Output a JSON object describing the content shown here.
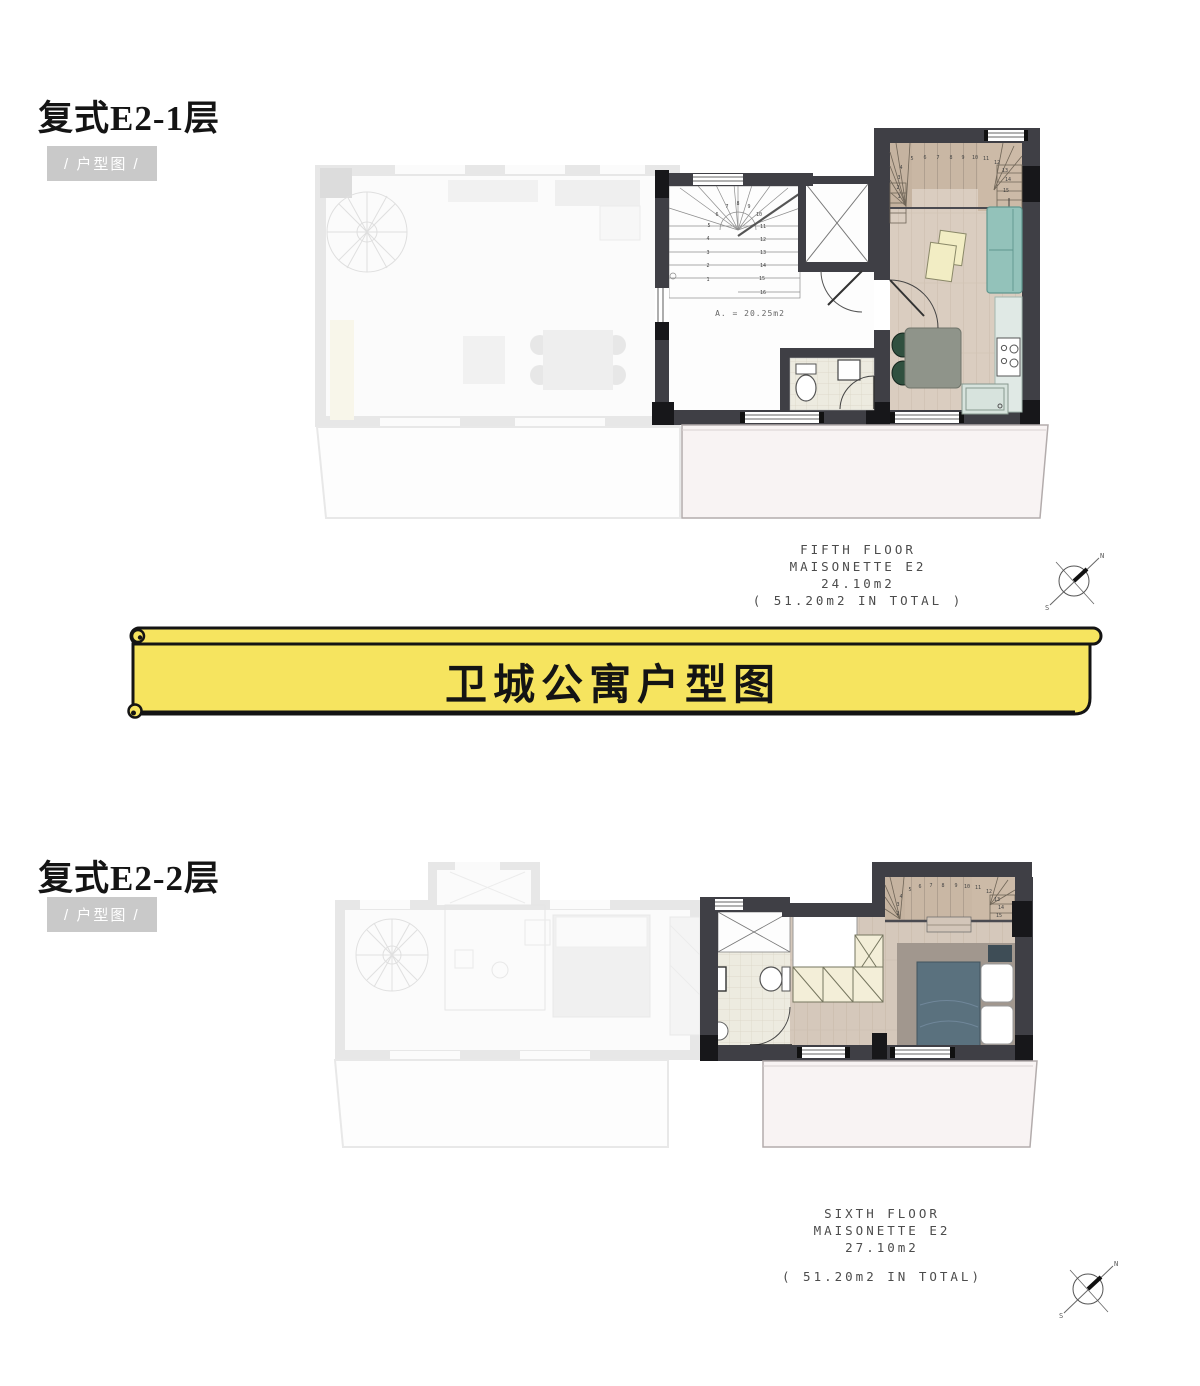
{
  "banner": {
    "title": "卫城公寓户型图",
    "fill": "#f6e45f"
  },
  "compass": {
    "north": "N",
    "south": "S"
  },
  "section1": {
    "heading": "复式E2-1层",
    "badge": "/ 户型图 /",
    "plan": {
      "area_label": "A. = 20.25m2",
      "stairwell_step_numbers": [
        "1",
        "2",
        "3",
        "4",
        "5",
        "6",
        "7",
        "8",
        "9",
        "10",
        "11",
        "12",
        "13",
        "14",
        "15",
        "16"
      ],
      "unit_stair_numbers": [
        "1",
        "2",
        "3",
        "4",
        "5",
        "6",
        "7",
        "8",
        "9",
        "10",
        "11",
        "12",
        "13",
        "14",
        "15"
      ]
    },
    "caption": {
      "line1": "FIFTH FLOOR",
      "line2": "MAISONETTE E2",
      "line3": "24.10m2",
      "line4": "( 51.20m2 IN TOTAL )"
    }
  },
  "section2": {
    "heading": "复式E2-2层",
    "badge": "/ 户型图 /",
    "plan": {
      "unit_stair_numbers": [
        "2",
        "3",
        "4",
        "5",
        "6",
        "7",
        "8",
        "9",
        "10",
        "11",
        "12",
        "13",
        "14",
        "15"
      ]
    },
    "caption": {
      "line1": "SIXTH FLOOR",
      "line2": "MAISONETTE E2",
      "line3": "27.10m2",
      "line4": "( 51.20m2 IN TOTAL)"
    }
  },
  "colors": {
    "banner_yellow": "#f6e45f",
    "badge_gray": "#c9c9c9",
    "wall_dark": "#3f3f45",
    "wood_floor": "#dacdc0",
    "stair_tread": "#c9b7a4",
    "sofa_teal": "#93c2ba",
    "bed_slate": "#5a717e",
    "terrace": "#f8f3f3"
  }
}
